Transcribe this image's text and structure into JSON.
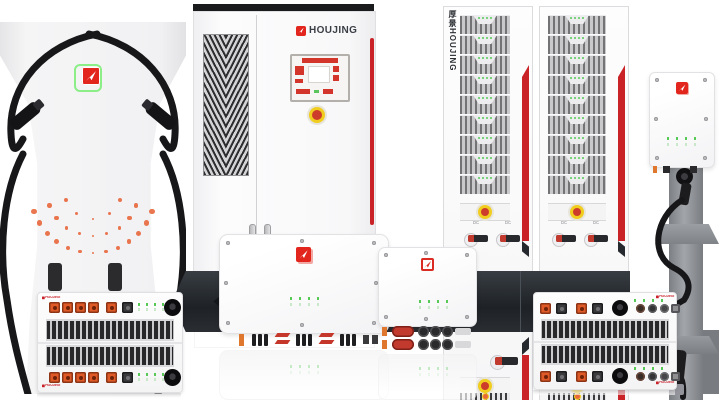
{
  "scene": {
    "background": "#ffffff"
  },
  "brand": {
    "cabinet_label": "HOUJING",
    "rack_vertical_label": "厚景HOUJING",
    "module_small_label": "HOUJING",
    "colors": {
      "logo_red": "#e3261d",
      "logo_green_ring": "#8bee86",
      "text_dark": "#3a3e45",
      "stripe_red": "#c92227",
      "estop_yellow": "#f0cd1e",
      "estop_red": "#cd3b2b",
      "led_green": "#57c957",
      "connector_orange": "#e05a28",
      "dot_orange": "#e8673c"
    }
  },
  "charger": {
    "dot_arcs": [
      {
        "radius": 63,
        "count": 13,
        "size": 4.5
      },
      {
        "radius": 46,
        "count": 9,
        "size": 3.5
      },
      {
        "radius": 29,
        "count": 5,
        "size": 3
      }
    ]
  },
  "racks": {
    "count": 2,
    "modules_per_rack": 9,
    "leds_per_module": 4,
    "switch_label": "DC",
    "switches_per_rack": 2
  },
  "cabinet": {
    "label": "HOUJING"
  },
  "modules": {
    "left_unit_orange_connectors": 5,
    "wide_unit_connector_pairs": 2,
    "led_columns": 4
  }
}
